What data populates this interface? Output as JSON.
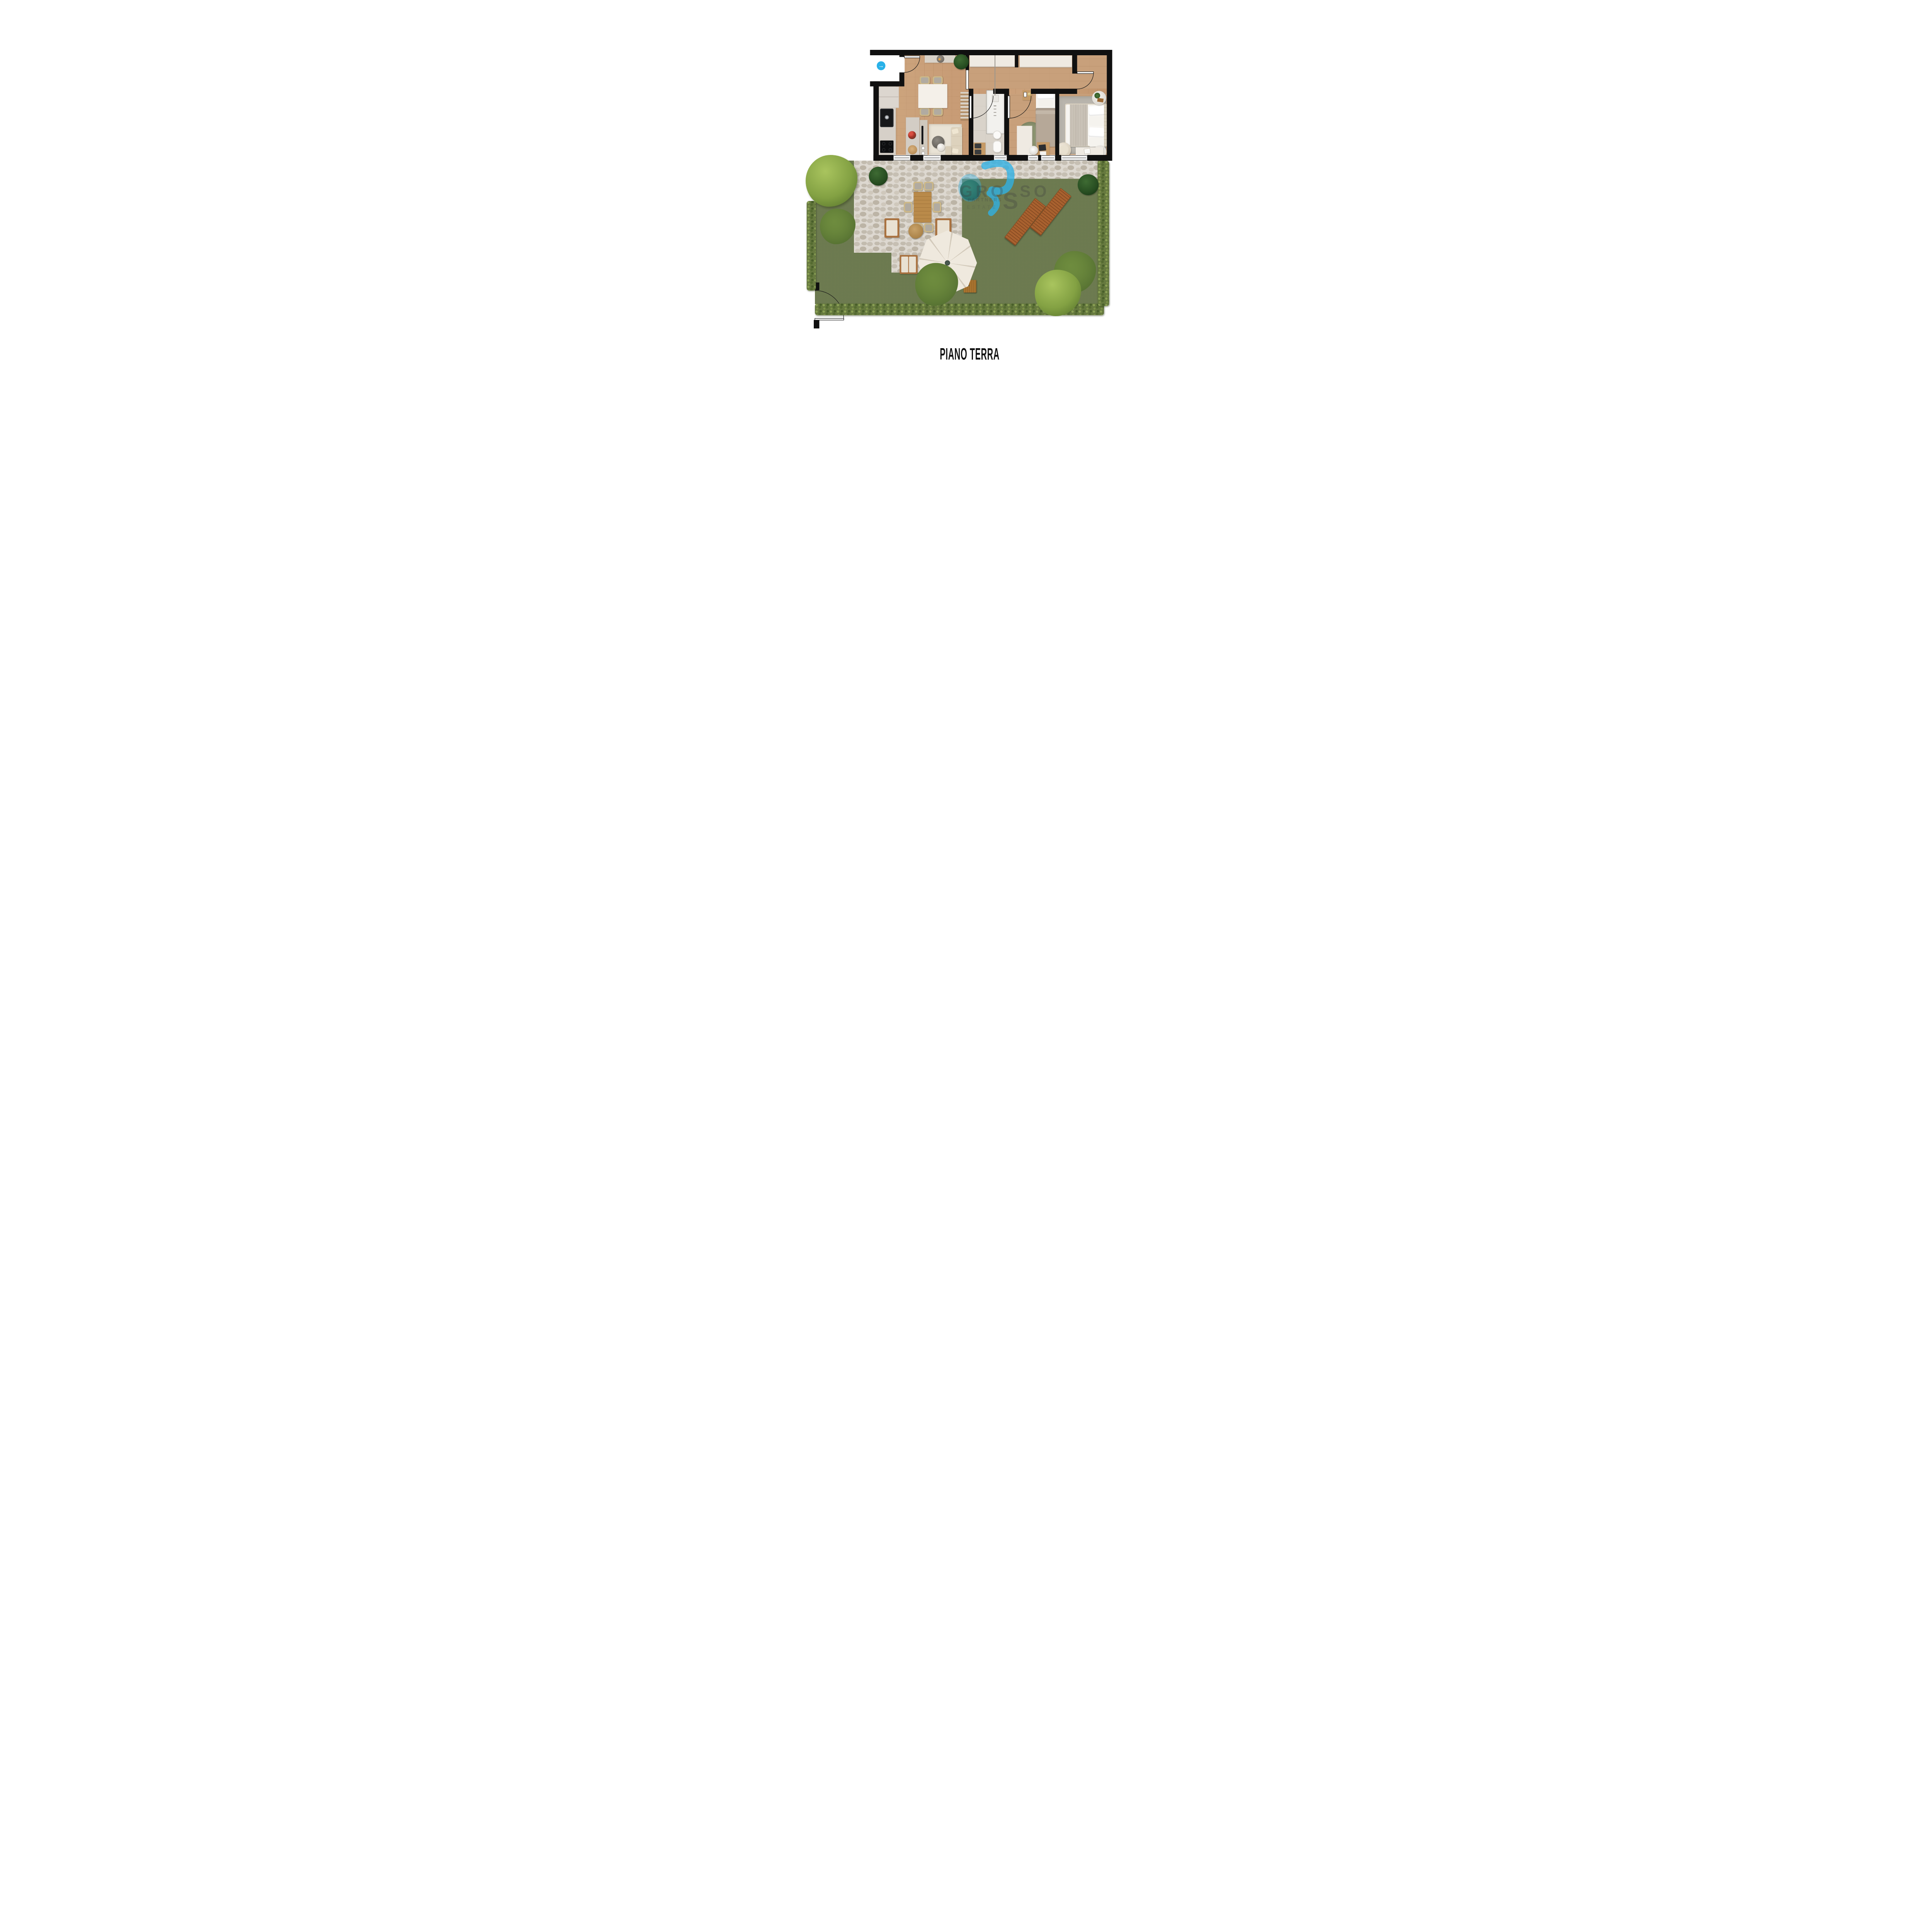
{
  "plan": {
    "title": "PIANO TERRA"
  },
  "watermark": {
    "brand_part1": "GRO",
    "brand_part2": "S",
    "brand_part3": "SO",
    "tagline": "& PARTNERS",
    "subline": "ESTATE"
  },
  "entrance": {
    "arrow_glyph": "→",
    "icon": "entrance-direction-arrow"
  },
  "colors": {
    "accent_blue": "#29b1e8",
    "wall_black": "#101010",
    "grass_green": "#6f7d52",
    "stone_grey": "#d8d3ca",
    "wood_floor": "#c9a07e",
    "hedge_green": "#66793f",
    "umbrella_cream": "#efe8dc",
    "lounger_wood": "#a8612f"
  }
}
